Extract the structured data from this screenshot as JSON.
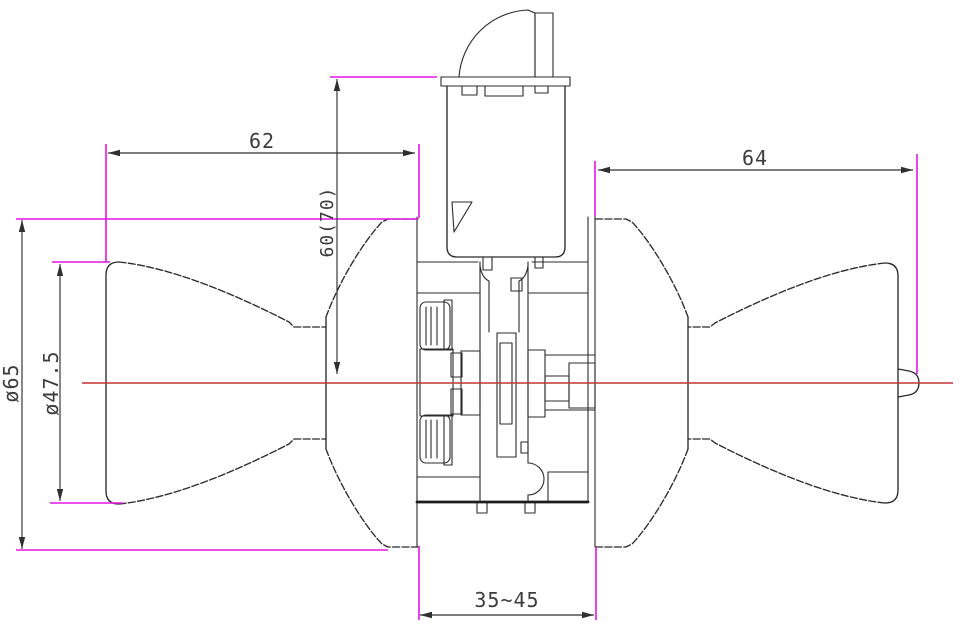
{
  "drawing": {
    "dimensions": {
      "left_knob_depth": {
        "value": "62"
      },
      "right_knob_depth": {
        "value": "64"
      },
      "cylinder_height": {
        "value": "60(70)"
      },
      "rose_diameter": {
        "value": "ø65"
      },
      "knob_diameter": {
        "value": "ø47.5"
      },
      "door_thickness_range": {
        "value": "35~45"
      }
    },
    "colors": {
      "outline": "#2b2b2b",
      "dimension_line": "#2f2f2f",
      "dimension_text": "#3c3c3c",
      "extension_line": "#e316e3",
      "centerline": "#c23535",
      "background": "#ffffff"
    }
  }
}
